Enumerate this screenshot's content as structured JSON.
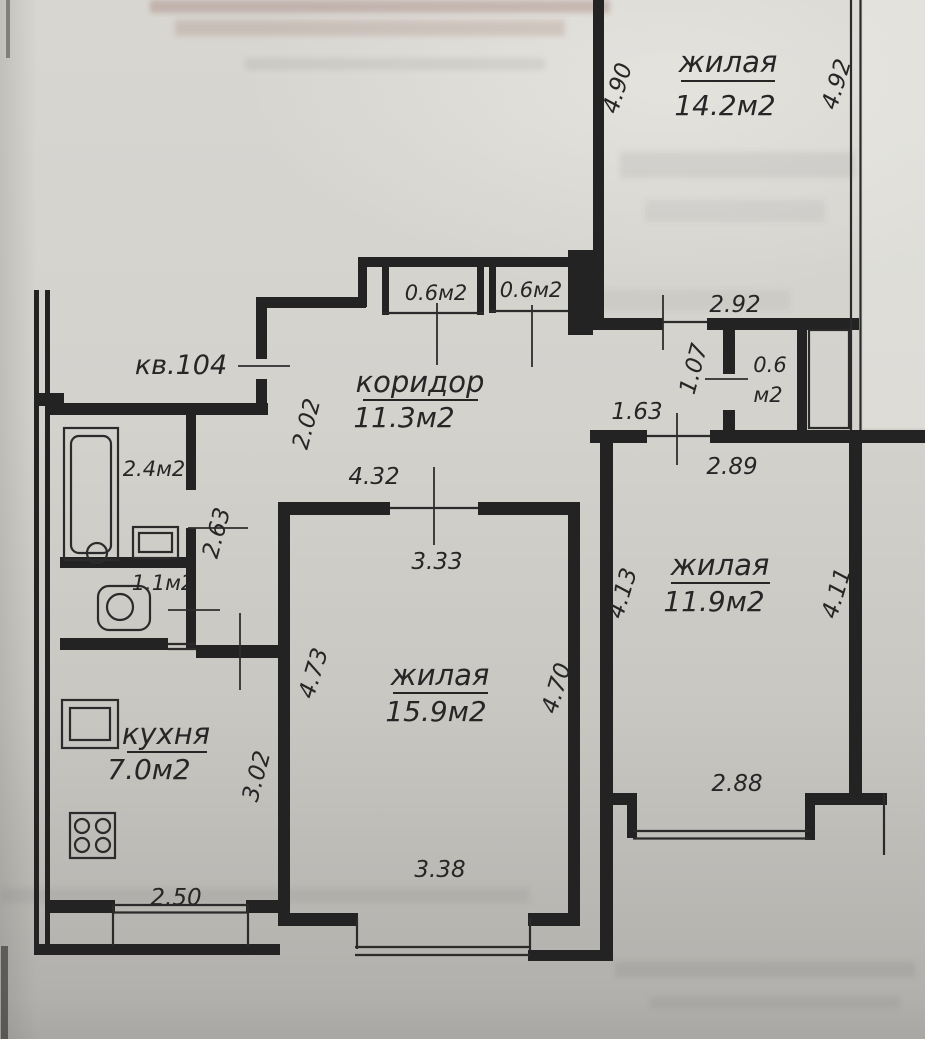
{
  "plan": {
    "apartment_label": "кв.104",
    "rooms": {
      "living_top": {
        "name": "жилая",
        "area": "14.2м2"
      },
      "balcony_closet_1": {
        "area": "0.6м2"
      },
      "balcony_closet_2": {
        "area": "0.6м2"
      },
      "corridor": {
        "name": "коридор",
        "area": "11.3м2"
      },
      "small_closet": {
        "area_line1": "0.6",
        "area_line2": "м2"
      },
      "bathroom": {
        "area": "2.4м2"
      },
      "toilet": {
        "area": "1.1м2"
      },
      "kitchen": {
        "name": "кухня",
        "area": "7.0м2"
      },
      "living_center": {
        "name": "жилая",
        "area": "15.9м2"
      },
      "living_right": {
        "name": "жилая",
        "area": "11.9м2"
      }
    },
    "dimensions": {
      "top_room_left": "4.90",
      "top_room_right": "4.92",
      "top_room_width": "2.92",
      "passage_height": "1.07",
      "door_width": "1.63",
      "right_room_top": "2.89",
      "entry_width": "2.02",
      "hall_width": "2.63",
      "corridor_length": "4.32",
      "center_room_top": "3.33",
      "center_room_left": "4.73",
      "center_room_right": "4.70",
      "right_room_left": "4.13",
      "right_room_right": "4.11",
      "kitchen_height": "3.02",
      "center_room_bottom": "3.38",
      "right_room_bottom": "2.88",
      "kitchen_width": "2.50"
    }
  }
}
